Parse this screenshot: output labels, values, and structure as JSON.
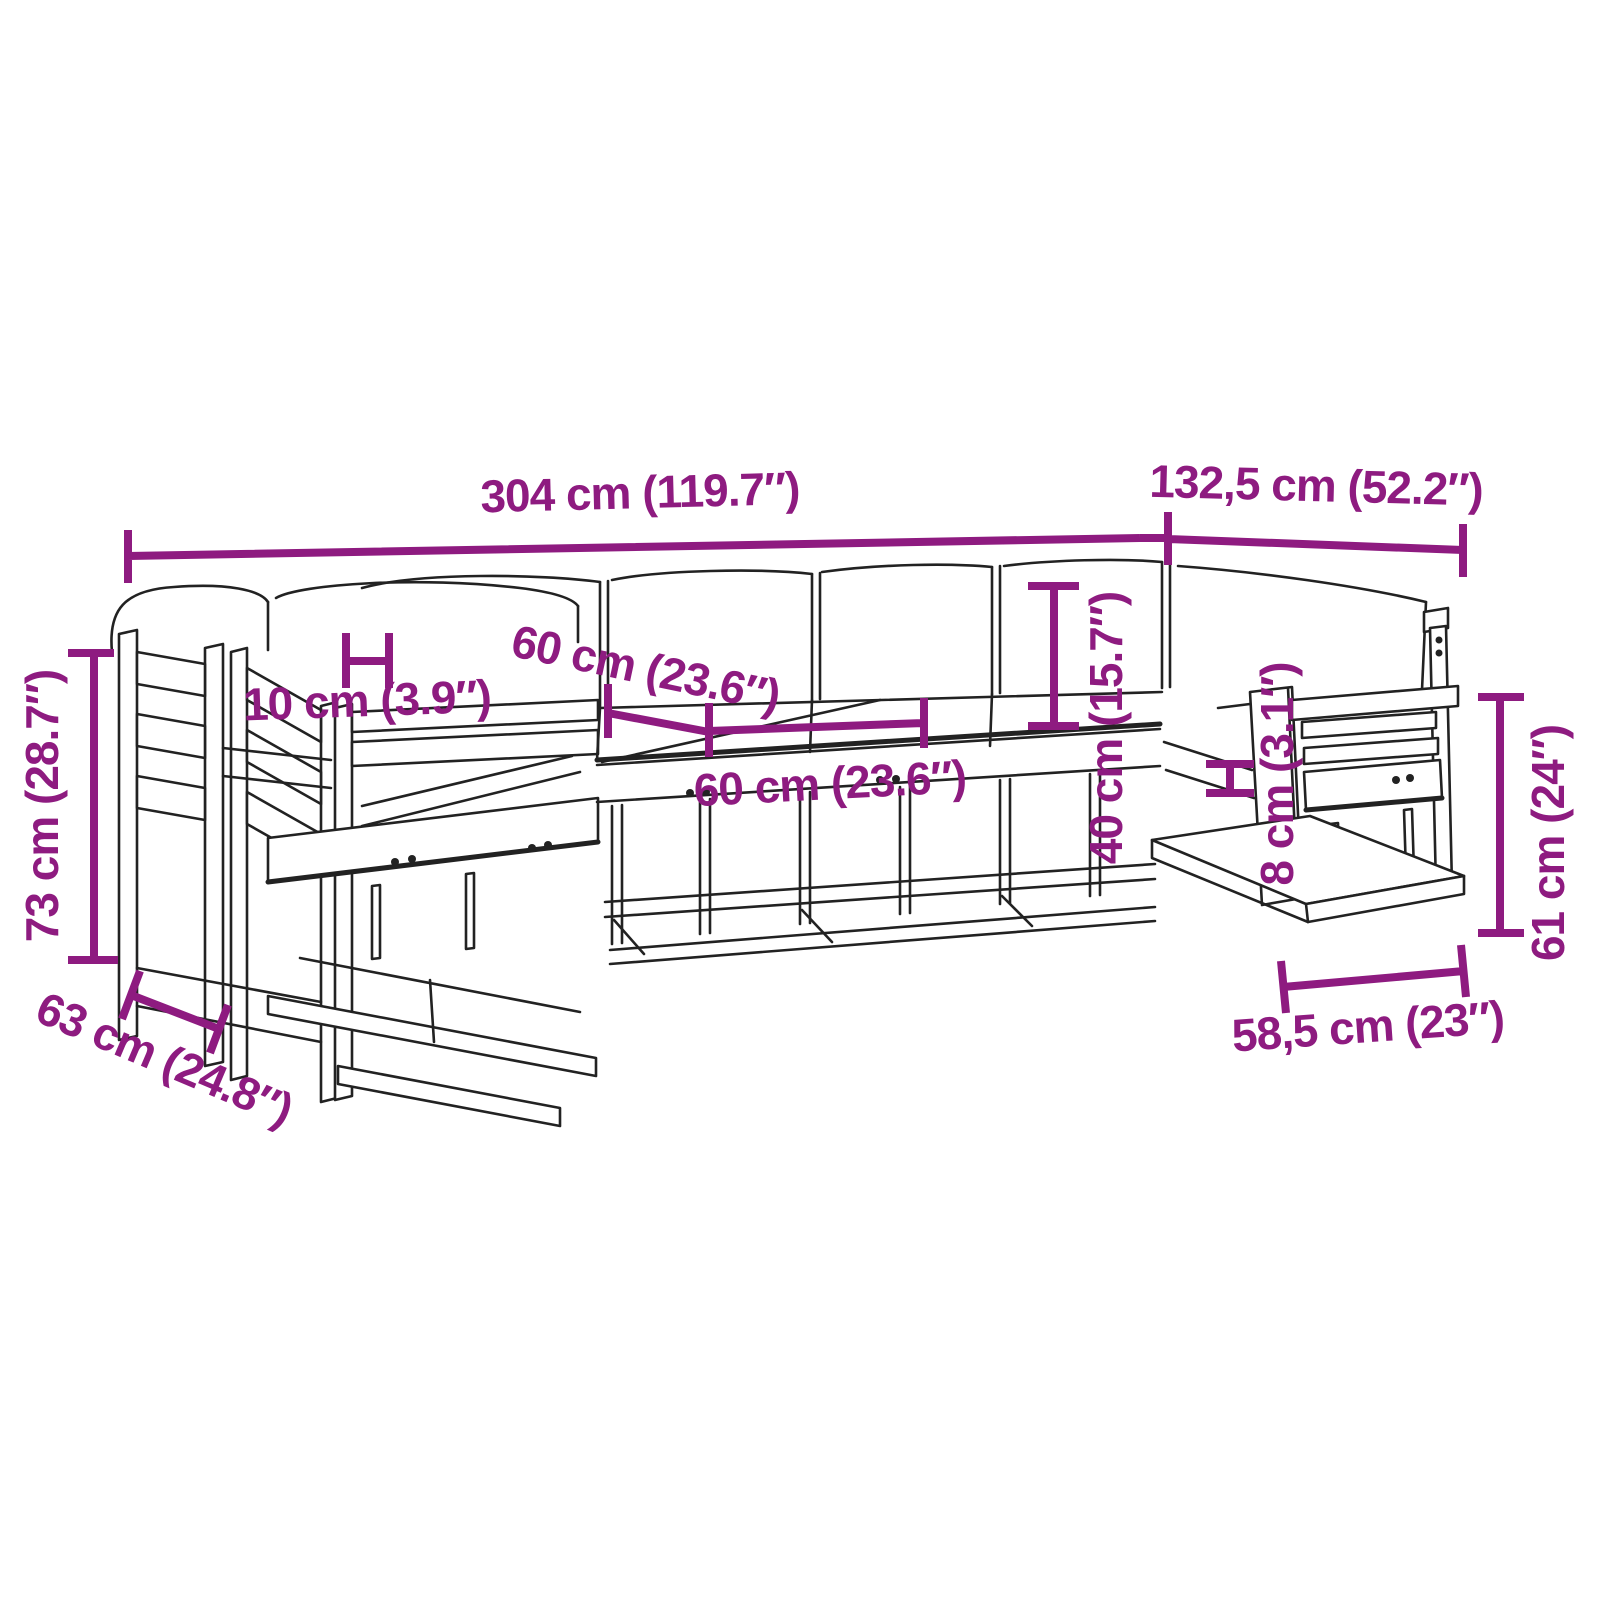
{
  "page": {
    "background": "#ffffff"
  },
  "drawing": {
    "description": "U-shaped wooden garden lounge sofa set with cushions, technical line drawing",
    "line_color": "#222222",
    "dimension_color": "#8e1b80"
  },
  "dimensions": {
    "overall_width": {
      "label": "304 cm (119.7″)"
    },
    "overall_depth_right": {
      "label": "132,5 cm (52.2″)"
    },
    "overall_height": {
      "label": "73 cm (28.7″)"
    },
    "left_module_depth": {
      "label": "63 cm (24.8″)"
    },
    "armrest_gap": {
      "label": "10 cm (3.9″)"
    },
    "seat_width_upper": {
      "label": "60 cm (23.6″)"
    },
    "seat_width_lower": {
      "label": "60 cm (23.6″)"
    },
    "backrest_height": {
      "label": "40 cm (15.7″)"
    },
    "cushion_thickness": {
      "label": "8 cm (3.1″)"
    },
    "armrest_height": {
      "label": "61 cm (24″)"
    },
    "right_module_width": {
      "label": "58,5 cm (23″)"
    }
  }
}
